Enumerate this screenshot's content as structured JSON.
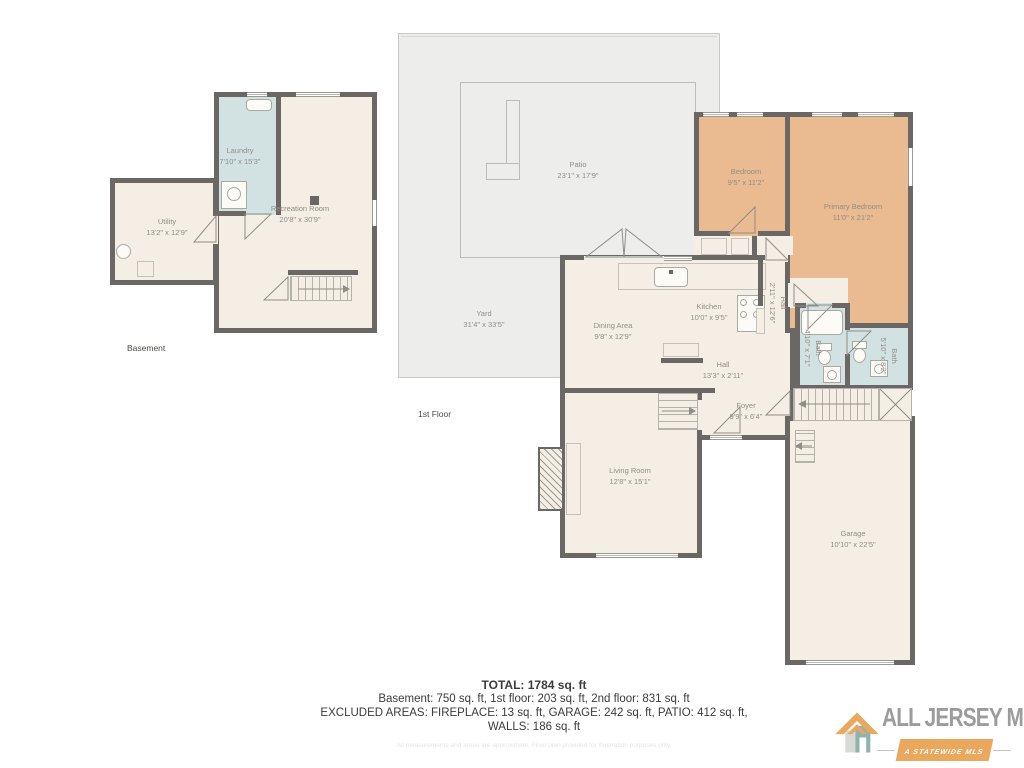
{
  "basement": {
    "floor_label": "Basement",
    "rooms": {
      "utility": {
        "name": "Utility",
        "dims": "13'2\" x 12'9\""
      },
      "laundry": {
        "name": "Laundry",
        "dims": "7'10\" x 15'3\""
      },
      "recreation": {
        "name": "Recreation Room",
        "dims": "20'8\" x 30'9\""
      }
    }
  },
  "first_floor": {
    "floor_label": "1st Floor",
    "rooms": {
      "patio": {
        "name": "Patio",
        "dims": "23'1\" x 17'9\""
      },
      "yard": {
        "name": "Yard",
        "dims": "31'4\" x 33'5\""
      },
      "bedroom": {
        "name": "Bedroom",
        "dims": "9'5\" x 11'2\""
      },
      "primary_bedroom": {
        "name": "Primary Bedroom",
        "dims": "11'0\" x 21'2\""
      },
      "kitchen": {
        "name": "Kitchen",
        "dims": "10'0\" x 9'5\""
      },
      "dining": {
        "name": "Dining Area",
        "dims": "9'8\" x 12'9\""
      },
      "hall_vertical": {
        "name": "Hall",
        "dims": "2'11\" x 12'6\""
      },
      "hall": {
        "name": "Hall",
        "dims": "13'3\" x 2'11\""
      },
      "foyer": {
        "name": "Foyer",
        "dims": "9'9\" x 6'4\""
      },
      "bath_main": {
        "name": "Bath",
        "dims": "4'10\" x 7'1\""
      },
      "bath_second": {
        "name": "Bath",
        "dims": "5'10\" x 8'2\""
      },
      "living": {
        "name": "Living Room",
        "dims": "12'8\" x 15'1\""
      },
      "garage": {
        "name": "Garage",
        "dims": "10'10\" x 22'5\""
      }
    }
  },
  "summary": {
    "total": "TOTAL: 1784 sq. ft",
    "floors": "Basement: 750 sq. ft, 1st floor: 203 sq. ft, 2nd floor: 831 sq. ft",
    "excluded": "EXCLUDED AREAS: FIREPLACE: 13 sq. ft, GARAGE: 242 sq. ft, PATIO: 412 sq. ft,",
    "walls": "WALLS: 186 sq. ft",
    "watermark": "All measurements and areas are approximate. Floor plan provided for illustration purposes only."
  },
  "logo": {
    "title": "ALL JERSEY MLS",
    "subtitle": "A STATEWIDE MLS"
  },
  "colors": {
    "wall": "#6b6764",
    "interior_floor": "#f5eee4",
    "bedroom_floor": "#eaba90",
    "bath_floor": "#d2e2e2",
    "outdoor": "#ededec",
    "label_text": "#8f8f88",
    "summary_text": "#3b3b3b",
    "brand_orange": "#e9a85e",
    "brand_teal": "#8fb3ae",
    "brand_gray": "#9c9c9c"
  }
}
